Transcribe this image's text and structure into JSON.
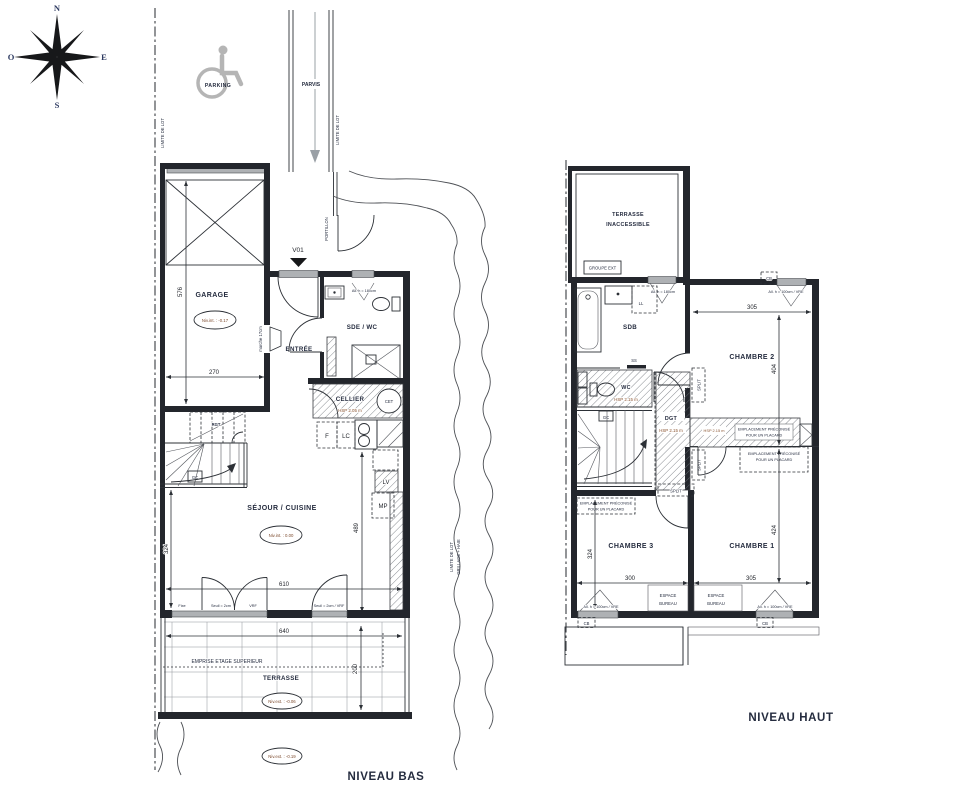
{
  "colors": {
    "line": "#2c3036",
    "wall": "#23262c",
    "label": "#252c3f",
    "hsp_text": "#8a5430",
    "level_text": "#7c4a2d",
    "gray_fill": "#aeb1b4",
    "compass_letters": "#2c3960",
    "icon_gray": "#b5b5b5"
  },
  "compass": {
    "n": "N",
    "e": "E",
    "s": "S",
    "o": "O"
  },
  "site": {
    "parking": "PARKING",
    "parvis": "PARVIS",
    "limite_lot": "LIMITE DE LOT",
    "haie_l1": "LIMITE DE LOT",
    "haie_l2": "GRILLAGE + HAIE",
    "portillon": "PORTILLON",
    "v01": "V01"
  },
  "bas": {
    "title": "NIVEAU BAS",
    "garage": "GARAGE",
    "garage_level": "Niv.int. : -0.17",
    "entree": "ENTRÉE",
    "marche": "marche 17cm",
    "sde_wc": "SDE / WC",
    "allege_180": "All. h = 180cm",
    "cellier": "CELLIER",
    "cellier_hsp": "HSP 2.05 m",
    "cet": "CET",
    "f": "F",
    "lc": "LC",
    "lv": "LV",
    "mp": "MP",
    "rgt": "RGT",
    "gc": "GC",
    "sejour": "SÉJOUR / CUISINE",
    "sejour_level": "Niv.int. : 0.00",
    "fixe": "Fixe",
    "seuil": "Seuil = 2cm",
    "vrf": "VRF",
    "seuil_vrf": "Seuil = 2cm / VRF",
    "emprise": "EMPRISE ETAGE SUPERIEUR",
    "terrasse": "TERRASSE",
    "terrasse_level": "Niv.ext. : -0.06",
    "ground_level": "Niv.ext. : -0.19",
    "dims": {
      "garage_h": "576",
      "garage_w": "270",
      "sejour_h": "324",
      "sejour_w": "610",
      "cuisine_h": "489",
      "terrasse_w": "640",
      "terrasse_h": "200"
    }
  },
  "haut": {
    "title": "NIVEAU HAUT",
    "terrasse_l1": "TERRASSE",
    "terrasse_l2": "INACCESSIBLE",
    "groupe_ext": "GROUPE EXT",
    "sdb": "SDB",
    "ll": "LL",
    "ss": "SS",
    "allege_180": "All. h = 180cm",
    "wc": "WC",
    "hsp": "HSP 2.15 m",
    "dgt": "DGT",
    "gc": "GC",
    "split": "SPLIT",
    "placard_l1": "EMPLACEMENT PRÉCONISÉ",
    "placard_l2": "POUR UN PLACARD",
    "ch1": "CHAMBRE 1",
    "ch2": "CHAMBRE 2",
    "ch3": "CHAMBRE 3",
    "bureau_l1": "ESPACE",
    "bureau_l2": "BUREAU",
    "cb": "CB",
    "allege_100": "All. h = 100cm / VRE",
    "dims": {
      "ch2_w": "305",
      "ch2_h": "404",
      "ch1_w": "305",
      "ch1_h": "424",
      "ch3_w": "300",
      "ch3_h": "324"
    }
  }
}
